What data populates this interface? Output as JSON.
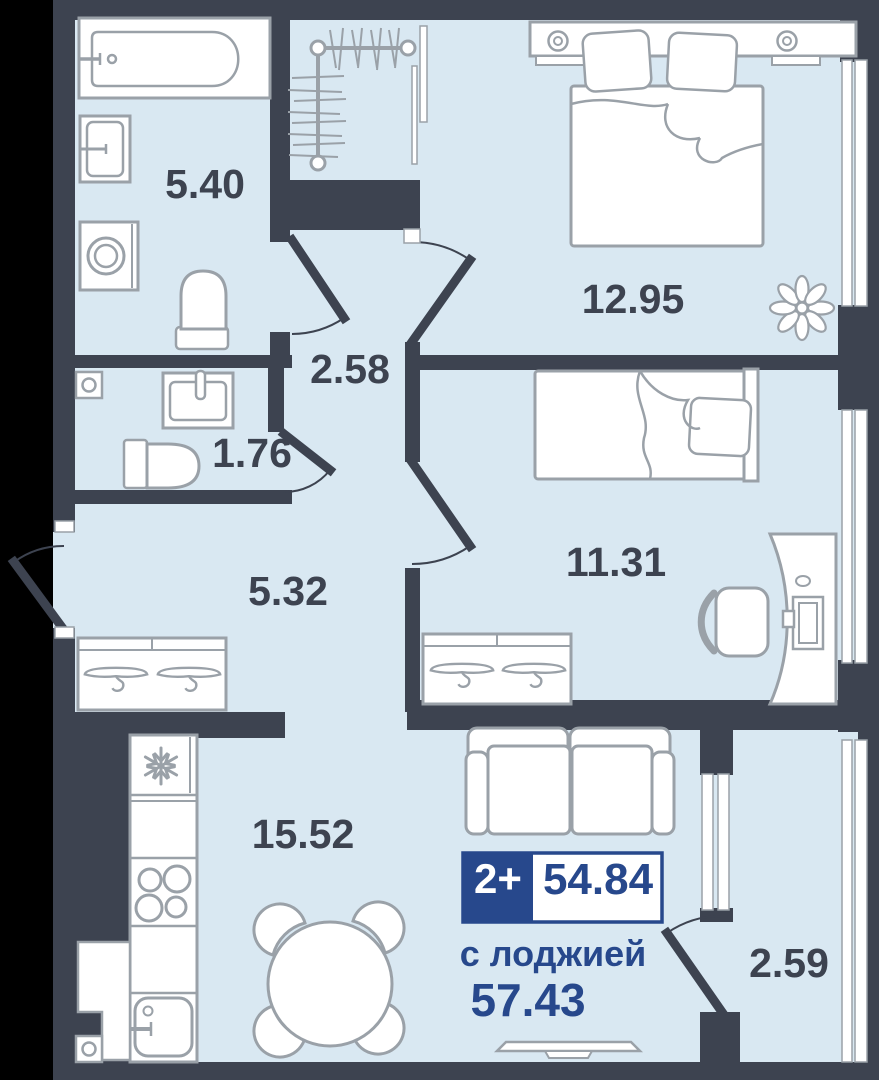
{
  "plan": {
    "rooms": {
      "bathroom": {
        "name": "bathroom",
        "area": "5.40"
      },
      "hall_small": {
        "name": "inner-hall",
        "area": "2.58"
      },
      "wc": {
        "name": "wc",
        "area": "1.76"
      },
      "hallway": {
        "name": "entry-hallway",
        "area": "5.32"
      },
      "bedroom_main": {
        "name": "bedroom-main",
        "area": "12.95"
      },
      "bedroom_second": {
        "name": "bedroom-second",
        "area": "11.31"
      },
      "kitchen_living": {
        "name": "kitchen-living",
        "area": "15.52"
      },
      "loggia": {
        "name": "loggia",
        "area": "2.59"
      }
    },
    "badge": {
      "rooms_label": "2+",
      "area_value": "54.84"
    },
    "caption": {
      "line1": "с лоджией",
      "line2": "57.43"
    },
    "colors": {
      "background": "#000000",
      "wall": "#3d4350",
      "floor": "#d9e8f2",
      "furniture_stroke": "#9aa1a8",
      "accent_navy": "#27488c"
    },
    "icons": [
      "bathtub-icon",
      "cabinet-icon",
      "washing-machine-icon",
      "toilet-icon",
      "vent-icon",
      "wc-sink-icon",
      "coat-rack-icon",
      "mirror-icon",
      "double-bed-icon",
      "nightstand-icon",
      "plant-icon",
      "single-bed-icon",
      "wardrobe-hangers-icon",
      "desk-icon",
      "office-chair-icon",
      "fridge-icon",
      "stove-icon",
      "kitchen-sink-icon",
      "dining-table-icon",
      "chair-icon",
      "sofa-icon",
      "tv-icon",
      "window",
      "door-swing"
    ]
  }
}
